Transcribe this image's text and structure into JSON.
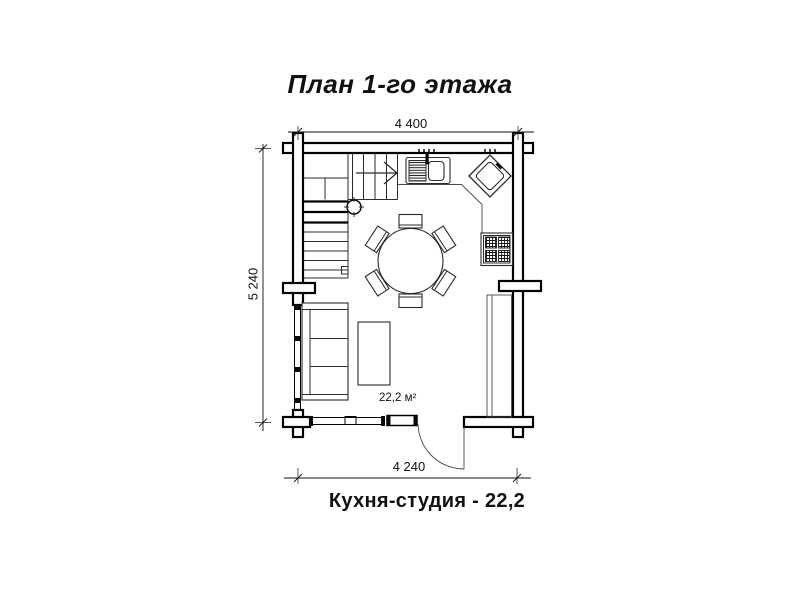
{
  "title": "План 1-го этажа",
  "caption": "Кухня-студия - 22,2",
  "dimensions": {
    "top": "4 400",
    "left": "5 240",
    "bottom": "4 240"
  },
  "room": {
    "area_label": "22,2 м²"
  },
  "colors": {
    "background": "#ffffff",
    "wall_line": "#000000",
    "furniture_line": "#2b2b2b"
  },
  "plan_elements": [
    "log-wall-corner-crosses",
    "staircase-winder",
    "stair-direction-arrow",
    "newel-post",
    "kitchen-sink-with-drainer",
    "faucet",
    "corner-sink-diamond",
    "kitchen-counter",
    "stove-four-burners",
    "tall-cabinet",
    "round-dining-table",
    "six-dining-chairs",
    "three-seat-sofa",
    "coffee-table",
    "entrance-door-swing",
    "window-left-wall",
    "window-bottom-wall"
  ]
}
